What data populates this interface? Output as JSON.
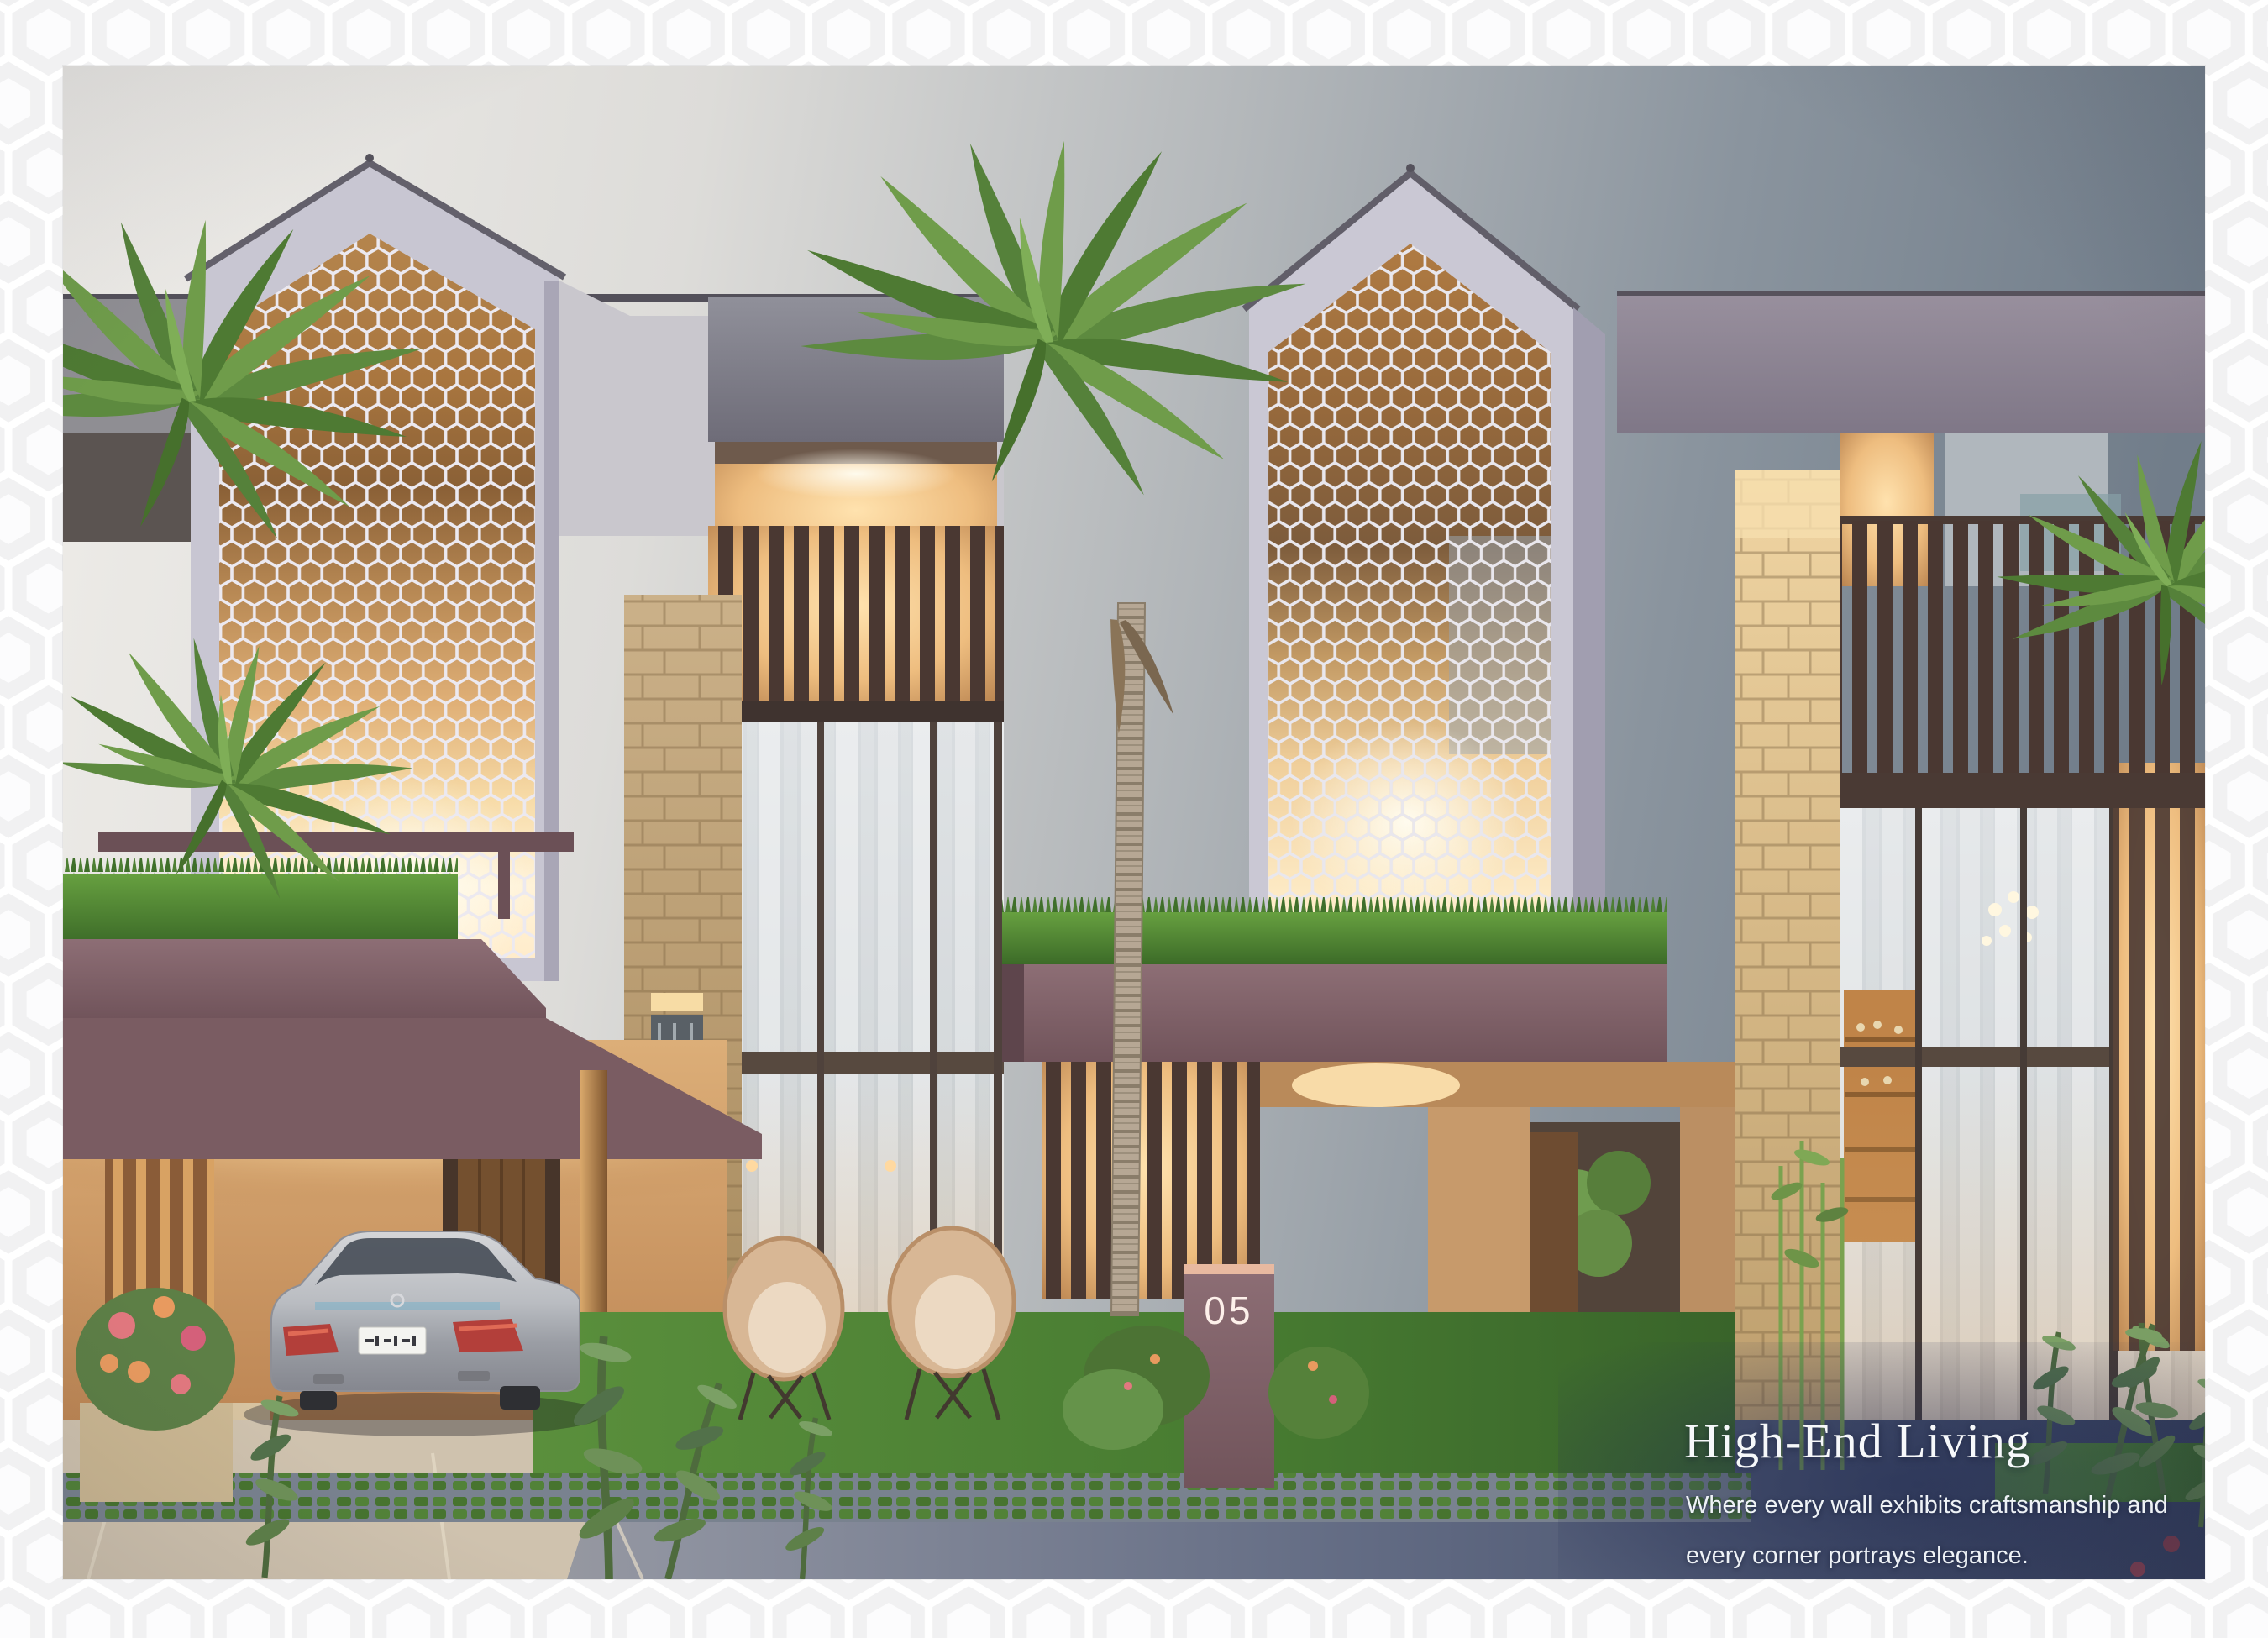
{
  "caption": {
    "title": "High-End Living",
    "line1": "Where every wall exhibits craftsmanship and",
    "line2": "every corner portrays elegance.",
    "text_color": "#ffffff"
  },
  "house": {
    "number": "05"
  },
  "scene": {
    "description": "Dusk rendering of modern row villas with hexagonal jali screen gables, palm trees, landscaped driveway and a parked silver sedan",
    "sky_left": "#edebe7",
    "sky_right": "#74808c",
    "screen_lattice": "#ece9f0",
    "accent_mauve": "#84666d",
    "accent_amber": "#e8b06e",
    "stone": "#d8bd92",
    "lawn": "#4e7f35",
    "road_dark": "#39415c"
  },
  "frame": {
    "background": "#fafafa",
    "hex_outline": "#ffffff",
    "hex_cell": "#f1f1f2"
  }
}
